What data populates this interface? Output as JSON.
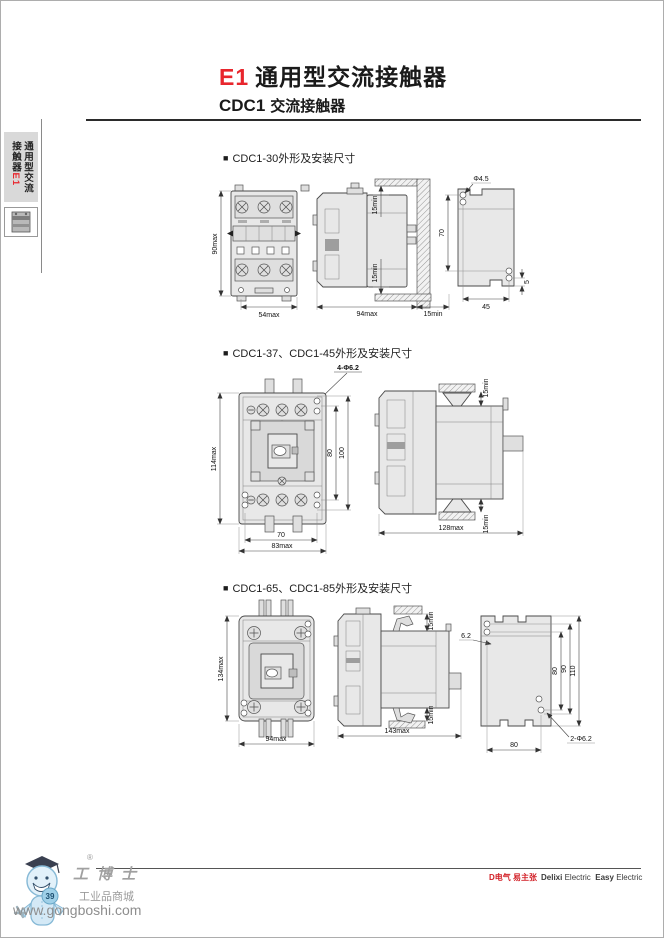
{
  "page": {
    "title_model": "E1",
    "title_text": "通用型交流接触器",
    "subtitle_model": "CDC1",
    "subtitle_text": "交流接触器",
    "bullet": "■"
  },
  "sidebar": {
    "tab_line1": "通用型交流",
    "tab_line2": "接触器",
    "tab_model": "E1"
  },
  "sections": [
    {
      "heading": "CDC1-30外形及安装尺寸",
      "front": {
        "height": "90max",
        "width": "54max"
      },
      "side": {
        "top_clearance": "15min",
        "bottom_clearance": "15min",
        "depth": "94max",
        "side_clearance": "15min"
      },
      "plate": {
        "hole": "Φ4.5",
        "hole_pitch_v": "70",
        "hole_pitch_h": "45",
        "edge_offset": "5"
      }
    },
    {
      "heading": "CDC1-37、CDC1-45外形及安装尺寸",
      "note": "4-Φ6.2",
      "front": {
        "height": "114max",
        "hole_pitch_v": "80",
        "outer_pitch_v": "100",
        "hole_pitch_h": "70",
        "width": "83max"
      },
      "side": {
        "top_clearance": "15min",
        "bottom_clearance": "15min",
        "depth": "128max"
      }
    },
    {
      "heading": "CDC1-65、CDC1-85外形及安装尺寸",
      "front": {
        "height": "134max",
        "width": "94max"
      },
      "side": {
        "top_clearance": "15min",
        "bottom_clearance": "15min",
        "depth": "143max"
      },
      "plate": {
        "slot": "6.2",
        "pitch_a": "80",
        "pitch_b": "90",
        "pitch_c": "110",
        "width": "80",
        "holes": "2-Φ6.2"
      }
    }
  ],
  "footer": {
    "page_number": "39",
    "logo_title": "工博士",
    "logo_subtitle": "工业品商城",
    "logo_url": "www.gongboshi.com",
    "registered_mark": "®",
    "brand_cn": "D电气 易主张",
    "brand_en_1": "Delixi",
    "brand_en_2": "Electric",
    "brand_en_3": "Easy",
    "brand_en_4": "Electric"
  }
}
